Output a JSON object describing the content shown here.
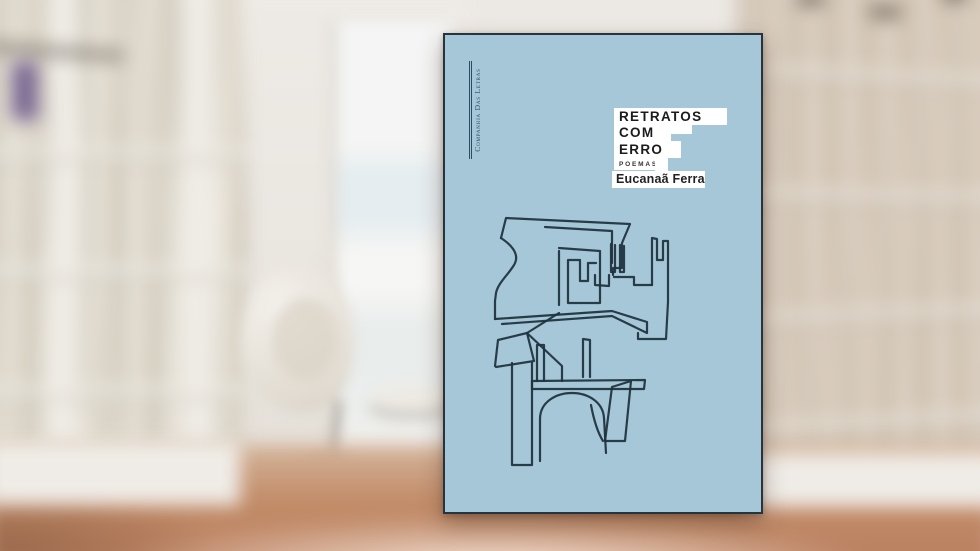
{
  "cover": {
    "publisher_logo_text": "Companhia Das Letras",
    "title_line_1": "RETRATOS",
    "title_line_2": "COM",
    "title_line_3": "ERRO",
    "genre_label": "POEMAS",
    "author_name": "Eucanaã Ferraz",
    "drawing_alt": "abstract continuous-line maze portrait drawing in dark ink on light blue cover",
    "colors": {
      "cover_blue": "#a5c7d8",
      "ink": "#20333f",
      "cover_border": "#27333d",
      "logo_blue": "#2b4a63"
    }
  },
  "scene": {
    "setting": "blurred bright home library: white bookshelves on both sides, white egg chair, window and warm wooden floor"
  }
}
